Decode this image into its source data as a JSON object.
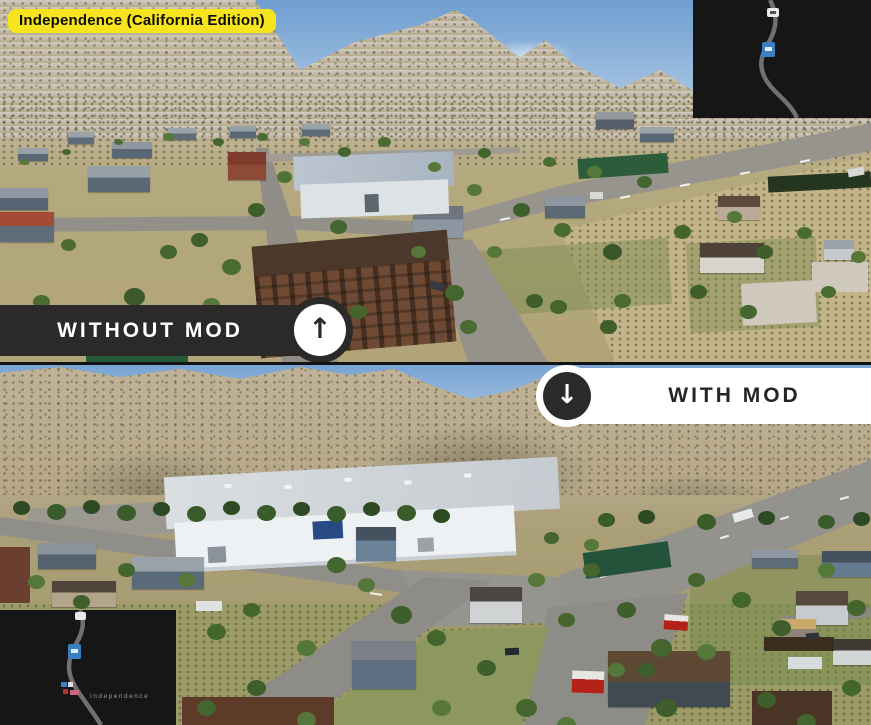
{
  "badge": {
    "label": "Independence (California Edition)"
  },
  "banners": {
    "without": {
      "label": "WITHOUT MOD"
    },
    "with": {
      "label": "WITH MOD"
    }
  },
  "icons": {
    "arrow_up": "↑",
    "arrow_down": "↓"
  },
  "minimap_bottom": {
    "town_label": "Independence"
  },
  "colors": {
    "badge_bg": "#f7e41f",
    "banner_dark": "#2b2a28",
    "banner_light": "#ffffff",
    "map_bg": "#161616",
    "map_road": "#707070",
    "map_marker_blue": "#3a7fc1",
    "truck_red": "#b32117"
  }
}
